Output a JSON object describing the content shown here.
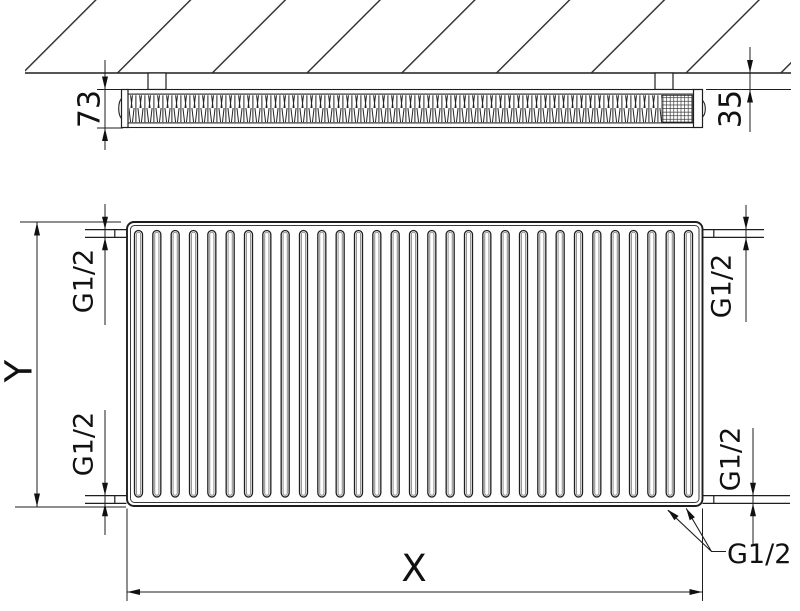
{
  "labels": {
    "depth": "73",
    "wall_gap": "35",
    "height": "Y",
    "width": "X",
    "conn_top_left": "G1/2",
    "conn_bottom_left": "G1/2",
    "conn_top_right": "G1/2",
    "conn_bottom_right": "G1/2",
    "conn_bottom_valve": "G1/2"
  },
  "front_view": {
    "channel_count": 31
  },
  "colors": {
    "line": "#1e1e1e",
    "text": "#111111",
    "background": "#ffffff",
    "channel_inner_line": "#8d8d8d"
  }
}
